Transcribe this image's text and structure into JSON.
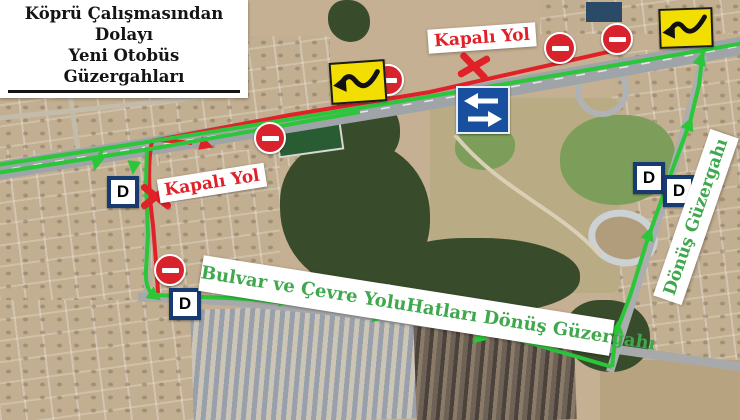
{
  "title": {
    "line1": "Köprü Çalışmasından Dolayı",
    "line2": "Yeni Otobüs Güzergahları"
  },
  "labels": {
    "closed_road_top": "Kapalı Yol",
    "closed_road_left": "Kapalı Yol",
    "bottom_route_banner": "Bulvar ve Çevre YoluHatları Dönüş Güzergahı",
    "right_route_banner": "Dönüş Güzergahı",
    "bus_stop_letter": "D"
  },
  "icons": {
    "no_entry_sign": "no-entry-icon",
    "lane_shift_sign": "lane-shift-icon",
    "two_way_traffic_sign": "two-way-traffic-icon",
    "closed_x_mark": "closed-x-icon",
    "bus_stop_sign": "bus-stop-d-icon"
  },
  "colors": {
    "route_green": "#2cc63a",
    "closed_red": "#e02128",
    "banner_text_green": "#3fa84c",
    "sign_yellow": "#f2de00",
    "sign_blue": "#184f9e",
    "d_sign_border_blue": "#173a70"
  }
}
